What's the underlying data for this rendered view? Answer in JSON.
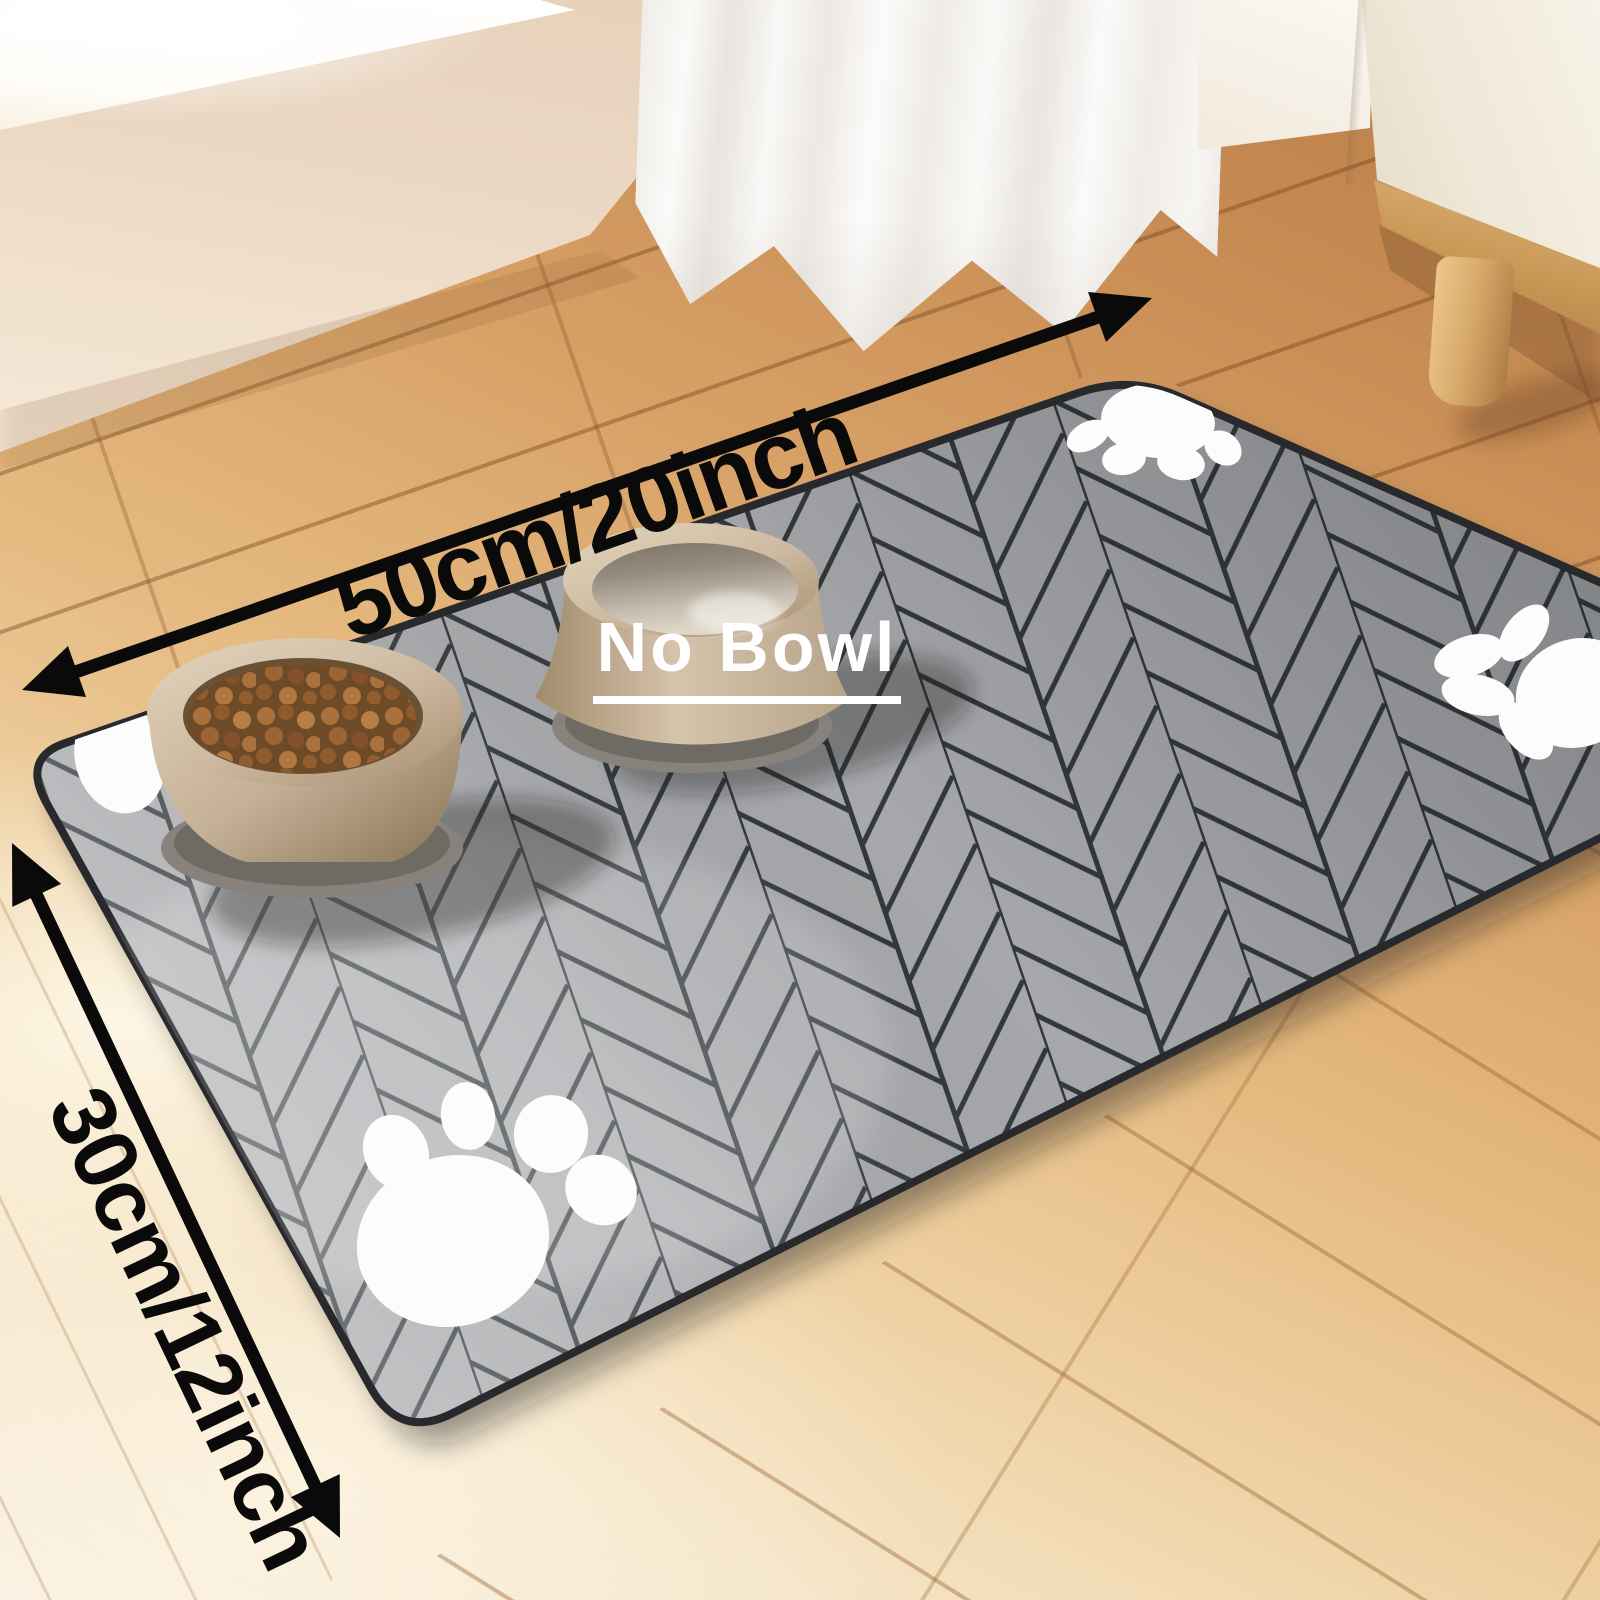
{
  "scene": {
    "type": "product-photo",
    "subject": "Absorbent pet feeding mat with a food bowl and a water bowl on a wooden floor",
    "annotations": {
      "width_label": "50cm/20inch",
      "height_label": "30cm/12inch",
      "center_label": "No Bowl"
    },
    "mat": {
      "pattern": "herringbone",
      "paw_print_count": 4,
      "colors": {
        "plank": "#a6a8ab",
        "seam": "#34383b",
        "edge": "#27292c",
        "paw_print": "#fcfcfd"
      }
    },
    "bowls": [
      {
        "name": "food-bowl",
        "contents": "kibble"
      },
      {
        "name": "water-bowl",
        "contents": "water"
      }
    ],
    "colors": {
      "arrow": "#0a0a0a",
      "dimension_text": "#0a0a0a",
      "center_label_text": "#ffffff",
      "floor_oak": "#c98e55",
      "floor_light": "#f7ecd8",
      "wall": "#ead7c3",
      "windowsill": "#fffdf8",
      "curtain": "#f6f4f1",
      "cabinet": "#f2ecdf",
      "cabinet_wood": "#c9995c",
      "bowl_body": "#c9b69d",
      "water": "#b7afa2",
      "kibble": "#96602f"
    }
  }
}
